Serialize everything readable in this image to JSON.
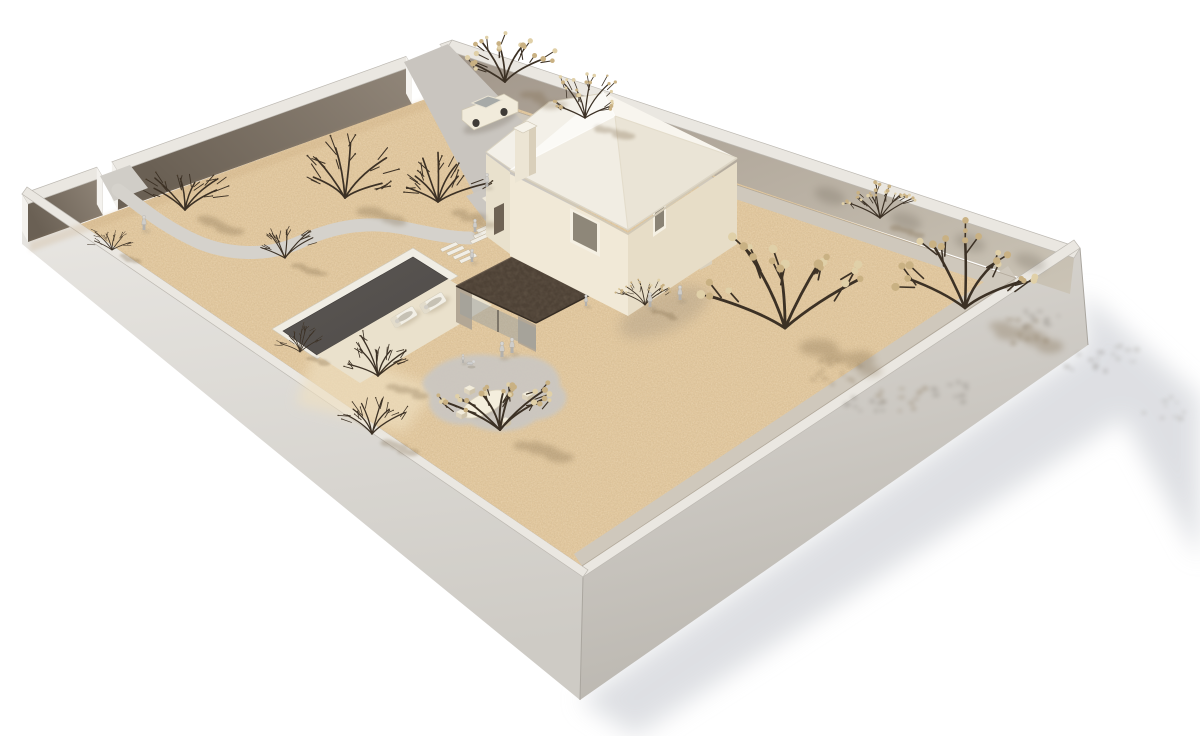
{
  "scene": {
    "width": 1200,
    "height": 736,
    "background": "#ffffff",
    "description": "Aerial 3D architectural rendering of a walled residential plot: two-storey house with pyramidal roof and chimney, dark flat-roofed pool pavilion, rectangular pool with sun loungers, winding footpath from a gate, driveway with parked car, gravel ground, flowering trees and small human figures"
  },
  "palette": {
    "bg": "#ffffff",
    "wallCap": "#eae7e1",
    "wallCapEdge": "#bdb9b2",
    "wallEnd": "#f4f2ee",
    "gradNW1": "#6a6054",
    "gradNW2": "#918679",
    "gradNE1": "#a1968a",
    "gradNE2": "#cbc4b6",
    "gradSWout1": "#e9e7e3",
    "gradSWout2": "#cecbc5",
    "gradSEout1": "#dedbd6",
    "gradSEout2": "#bab6af",
    "seam": "#aaa69f",
    "sand": "#e2c89f",
    "sandLight": "#efe0c1",
    "sandEdgeShade": "#c3a276",
    "stripGray": "#cfc8bc",
    "baseLine": "#a79d8e",
    "pathGray": "#d5d2cc",
    "driveGray": "#c9c5bf",
    "courtGray": "#cbc7c1",
    "gatePad": "#d0cdc7",
    "terrace": "#eee8d9",
    "poolWater1": "#5b5754",
    "poolWater2": "#4f4b48",
    "poolCoping": "#f0ede4",
    "poolDeck": "#eae1cc",
    "plank": "#f1eee6",
    "houseLight": "#f1e9d7",
    "houseMid": "#e7ddc7",
    "houseWing": "#e9e1cd",
    "roofNW": "#fbfaf6",
    "roofNE": "#f8f5ee",
    "roofSE": "#eae4d6",
    "roofSW": "#f1ede3",
    "wingRoof": "#f3f0e8",
    "fascia": "#d2c9b6",
    "ridgeLight": "#fdfcf9",
    "ridgeDark": "#e3dccb",
    "chimFront": "#ece5d4",
    "chimSide": "#d9cfba",
    "chimCap": "#f6f3ea",
    "doorDark": "#6e6254",
    "winFrame": "#f5f0e3",
    "winGlass": "#8e8779",
    "darkRoof": "#4e4236",
    "darkRoofEdge": "#352c23",
    "darkRoofHi": "#6a5c4d",
    "pier": "#b3a795",
    "pierLight": "#d9d0bd",
    "glass": "#9aa0a0",
    "mullion": "#4a443c",
    "interiorDark": "#463d33",
    "counterDark": "#2e2822",
    "treeBranch": "#3c3125",
    "bloom": "#c9b183",
    "bloomLight": "#e0d0a8",
    "budDark": "#4a3d2c",
    "shadowBrown": "#7c6647",
    "shadowGray": "#d6d8dd",
    "blobShadow": "#978b7c",
    "wallShadow": "#6b6255",
    "extSpeckle": "#9a958c",
    "figureLegs": "#b3b1ad",
    "figureBody": "#cfcdc9",
    "figureHead": "#d8d6d2",
    "figureEdge": "#a09e9a",
    "figureShadow": "#8a8070",
    "carBody": "#f1ebdb",
    "carGlass": "#a7aaa8",
    "carWheel": "#3f3b37",
    "carShadow": "#6f6658"
  },
  "walls": {
    "nw": {
      "from": [
        22,
        194
      ],
      "to": [
        452,
        40
      ],
      "capOffset": [
        6,
        10
      ],
      "faceHeight": 38,
      "segments": [
        [
          0,
          0.174
        ],
        [
          0.209,
          0.893
        ],
        [
          0.972,
          1.0
        ]
      ]
    },
    "neCap": [
      [
        452,
        40
      ],
      [
        1080,
        248
      ],
      [
        1074,
        258
      ],
      [
        446,
        50
      ]
    ],
    "neFace": [
      [
        446,
        50
      ],
      [
        1074,
        258
      ],
      [
        1070,
        294
      ],
      [
        446,
        88
      ]
    ],
    "seCap": [
      [
        1080,
        248
      ],
      [
        583,
        577
      ],
      [
        577,
        569
      ],
      [
        1074,
        240
      ]
    ],
    "swCap": [
      [
        583,
        577
      ],
      [
        22,
        194
      ],
      [
        27,
        187
      ],
      [
        588,
        570
      ]
    ],
    "seOuter": [
      [
        1080,
        248
      ],
      [
        583,
        577
      ],
      [
        580,
        700
      ],
      [
        1088,
        345
      ]
    ],
    "swOuter": [
      [
        583,
        577
      ],
      [
        22,
        194
      ],
      [
        22,
        244
      ],
      [
        580,
        700
      ]
    ],
    "seamE": [
      [
        1080,
        248
      ],
      [
        1088,
        345
      ]
    ],
    "seamS": [
      [
        583,
        577
      ],
      [
        580,
        700
      ]
    ]
  },
  "ground": {
    "sand": [
      [
        81,
        224
      ],
      [
        456,
        88
      ],
      [
        1016,
        278
      ],
      [
        582,
        566
      ]
    ],
    "stripNE": [
      [
        446,
        88
      ],
      [
        1016,
        278
      ],
      [
        1011,
        291
      ],
      [
        442,
        101
      ]
    ],
    "stripSE": [
      [
        1016,
        278
      ],
      [
        582,
        566
      ],
      [
        574,
        554
      ],
      [
        1008,
        266
      ]
    ],
    "baseLineNE": [
      [
        446,
        88
      ],
      [
        1016,
        278
      ]
    ],
    "baseLineSE": [
      [
        1016,
        278
      ],
      [
        582,
        566
      ]
    ],
    "nwEdgeShade": [
      [
        30,
        242
      ],
      [
        456,
        88
      ],
      [
        456,
        98
      ],
      [
        30,
        252
      ]
    ],
    "beach": [
      [
        318,
        342
      ],
      [
        436,
        388
      ],
      [
        404,
        432
      ],
      [
        296,
        404
      ]
    ]
  },
  "paths": {
    "gatePad": [
      [
        100,
        176
      ],
      [
        130,
        165
      ],
      [
        148,
        188
      ],
      [
        114,
        201
      ]
    ],
    "walk": "M118,190 C140,206 162,226 198,242 C226,254 266,258 300,242 C330,228 364,220 404,228 C432,234 452,238 470,238",
    "walkWidth": 13,
    "drive": [
      [
        404,
        62
      ],
      [
        448,
        44
      ],
      [
        560,
        160
      ],
      [
        480,
        205
      ]
    ],
    "court": [
      [
        466,
        196
      ],
      [
        556,
        162
      ],
      [
        592,
        200
      ],
      [
        502,
        242
      ]
    ],
    "terrace": [
      [
        482,
        198
      ],
      [
        514,
        184
      ],
      [
        536,
        204
      ],
      [
        504,
        219
      ]
    ],
    "poolSteps": {
      "x": 440,
      "y": 249,
      "count": 4,
      "dx": 6.3,
      "dy": 3.8,
      "len": 16
    },
    "entrySteps": {
      "x": 476,
      "y": 230,
      "count": 3,
      "dx": -3,
      "dy": 5.5,
      "len": 18
    }
  },
  "pool": {
    "coping": [
      [
        272,
        329
      ],
      [
        413,
        248
      ],
      [
        458,
        276
      ],
      [
        317,
        359
      ]
    ],
    "water": [
      [
        283,
        331
      ],
      [
        413,
        257
      ],
      [
        448,
        279
      ],
      [
        317,
        355
      ]
    ],
    "deck": [
      [
        448,
        279
      ],
      [
        492,
        305
      ],
      [
        360,
        383
      ],
      [
        317,
        355
      ]
    ],
    "loungers": [
      [
        404,
        317
      ],
      [
        433,
        303
      ]
    ]
  },
  "patio": {
    "blob": "M430,372 C446,356 478,350 506,358 C536,350 562,366 560,386 C576,398 560,418 536,420 C520,434 488,434 470,424 C444,428 424,412 430,396 C420,386 420,380 430,372 Z",
    "table": {
      "cx": 484,
      "cy": 404,
      "rx": 24,
      "ry": 10,
      "rot": -27
    },
    "chairs": [
      [
        456,
        412
      ],
      [
        500,
        420
      ],
      [
        522,
        394
      ],
      [
        464,
        388
      ]
    ]
  },
  "pavilion": {
    "interior": [
      [
        466,
        290
      ],
      [
        562,
        240
      ],
      [
        634,
        272
      ],
      [
        540,
        318
      ]
    ],
    "counter": [
      [
        562,
        298
      ],
      [
        608,
        274
      ],
      [
        608,
        284
      ],
      [
        562,
        308
      ]
    ],
    "glassSW": [
      [
        460,
        292
      ],
      [
        536,
        328
      ],
      [
        536,
        350
      ],
      [
        460,
        314
      ]
    ],
    "piers": [
      [
        [
          456,
          286
        ],
        [
          472,
          294
        ],
        [
          472,
          330
        ],
        [
          456,
          322
        ]
      ],
      [
        [
          518,
          316
        ],
        [
          536,
          325
        ],
        [
          536,
          352
        ],
        [
          518,
          343
        ]
      ],
      [
        [
          558,
          238
        ],
        [
          570,
          232
        ],
        [
          570,
          264
        ],
        [
          558,
          270
        ]
      ]
    ],
    "roof": [
      [
        456,
        286
      ],
      [
        566,
        229
      ],
      [
        646,
        266
      ],
      [
        536,
        323
      ]
    ],
    "canopy": [
      [
        624,
        268
      ],
      [
        708,
        230
      ],
      [
        716,
        238
      ],
      [
        632,
        276
      ]
    ],
    "canopyInterior": [
      [
        632,
        276
      ],
      [
        706,
        242
      ],
      [
        706,
        254
      ],
      [
        632,
        288
      ]
    ],
    "lowerGlass": [
      [
        630,
        278
      ],
      [
        708,
        244
      ],
      [
        708,
        264
      ],
      [
        630,
        298
      ]
    ],
    "pierE": [
      [
        700,
        238
      ],
      [
        712,
        232
      ],
      [
        712,
        264
      ],
      [
        700,
        270
      ]
    ],
    "pierS": [
      [
        628,
        280
      ],
      [
        640,
        274
      ],
      [
        640,
        302
      ],
      [
        628,
        308
      ]
    ],
    "shadowBlob": {
      "cx": 664,
      "cy": 312,
      "rx": 48,
      "ry": 20,
      "rot": -24
    }
  },
  "house": {
    "swFace": [
      [
        510,
        174
      ],
      [
        628,
        234
      ],
      [
        628,
        316
      ],
      [
        510,
        256
      ]
    ],
    "seFace": [
      [
        628,
        234
      ],
      [
        737,
        162
      ],
      [
        737,
        244
      ],
      [
        628,
        316
      ]
    ],
    "apex": [
      615,
      116
    ],
    "eaveW": [
      510,
      170
    ],
    "eaveN": [
      603,
      92
    ],
    "eaveE": [
      737,
      158
    ],
    "eaveS": [
      628,
      230
    ],
    "wingRoof": [
      [
        486,
        152
      ],
      [
        549,
        102
      ],
      [
        604,
        93
      ],
      [
        512,
        170
      ]
    ],
    "wingFace": [
      [
        486,
        154
      ],
      [
        510,
        172
      ],
      [
        510,
        254
      ],
      [
        486,
        236
      ]
    ],
    "door": [
      [
        494,
        208
      ],
      [
        504,
        203
      ],
      [
        504,
        230
      ],
      [
        494,
        235
      ]
    ],
    "chimneyFront": [
      [
        515,
        130
      ],
      [
        529,
        123
      ],
      [
        529,
        176
      ],
      [
        515,
        183
      ]
    ],
    "chimneySide": [
      [
        529,
        123
      ],
      [
        536,
        127
      ],
      [
        536,
        173
      ],
      [
        529,
        176
      ]
    ],
    "chimneyCap": [
      [
        513,
        128
      ],
      [
        527,
        121
      ],
      [
        537,
        126
      ],
      [
        523,
        133
      ]
    ],
    "winSwFrame": [
      [
        570,
        208
      ],
      [
        600,
        223
      ],
      [
        600,
        257
      ],
      [
        570,
        242
      ]
    ],
    "winSwGlass": [
      [
        573,
        212
      ],
      [
        597,
        224
      ],
      [
        597,
        252
      ],
      [
        573,
        240
      ]
    ],
    "winWingFrame": [
      [
        517,
        194
      ],
      [
        537,
        204
      ],
      [
        537,
        248
      ],
      [
        517,
        238
      ]
    ],
    "winWingGlass": [
      [
        520,
        198
      ],
      [
        534,
        205
      ],
      [
        534,
        244
      ],
      [
        520,
        237
      ]
    ],
    "winSeFrame": [
      [
        653,
        199
      ],
      [
        666,
        190
      ],
      [
        666,
        228
      ],
      [
        653,
        237
      ]
    ],
    "winSeGlass": [
      [
        655,
        202
      ],
      [
        664,
        196
      ],
      [
        664,
        226
      ],
      [
        655,
        232
      ]
    ]
  },
  "car": {
    "body": [
      [
        462,
        110
      ],
      [
        504,
        94
      ],
      [
        518,
        102
      ],
      [
        518,
        112
      ],
      [
        474,
        130
      ],
      [
        462,
        120
      ]
    ],
    "cabin": [
      [
        472,
        103
      ],
      [
        488,
        96
      ],
      [
        502,
        100
      ],
      [
        486,
        108
      ]
    ],
    "wheels": [
      [
        476,
        123
      ],
      [
        504,
        112
      ]
    ],
    "shadow": {
      "cx": 490,
      "cy": 122,
      "rx": 28,
      "ry": 8,
      "rot": -20
    }
  },
  "trees": [
    [
      185,
      210,
      1.0,
      0
    ],
    [
      285,
      258,
      0.75,
      0
    ],
    [
      345,
      198,
      1.15,
      0
    ],
    [
      438,
      202,
      1.1,
      0
    ],
    [
      505,
      82,
      1.15,
      1
    ],
    [
      585,
      118,
      0.85,
      1
    ],
    [
      112,
      250,
      0.55,
      0
    ],
    [
      378,
      376,
      0.9,
      0
    ],
    [
      300,
      352,
      0.55,
      0
    ],
    [
      372,
      434,
      0.85,
      0
    ],
    [
      500,
      430,
      1.3,
      1
    ],
    [
      645,
      305,
      0.6,
      1
    ],
    [
      880,
      218,
      0.8,
      1
    ],
    [
      785,
      328,
      1.9,
      1
    ],
    [
      965,
      308,
      1.7,
      1
    ]
  ],
  "people": [
    [
      144,
      230,
      0.9
    ],
    [
      487,
      187,
      0.85
    ],
    [
      475,
      232,
      0.8
    ],
    [
      472,
      262,
      0.8
    ],
    [
      502,
      357,
      0.95
    ],
    [
      512,
      353,
      0.95
    ],
    [
      650,
      307,
      0.9
    ],
    [
      680,
      300,
      0.9
    ],
    [
      586,
      306,
      0.7
    ],
    [
      463,
      363,
      0.55
    ]
  ],
  "dog": [
    470,
    366
  ],
  "wallShadows": {
    "neFaceBlobs": [
      [
        830,
        196
      ],
      [
        906,
        221
      ],
      [
        970,
        243
      ],
      [
        1030,
        262
      ]
    ],
    "sandClusters": [
      [
        838,
        372
      ],
      [
        902,
        398
      ],
      [
        1028,
        332
      ]
    ],
    "seOuterClusters": [
      [
        1040,
        318
      ],
      [
        1086,
        362
      ],
      [
        948,
        392
      ],
      [
        866,
        404
      ]
    ],
    "groundClusters": [
      [
        1118,
        356
      ],
      [
        1162,
        408
      ]
    ]
  },
  "extShadows": {
    "right": [
      [
        1082,
        292
      ],
      [
        1200,
        398
      ],
      [
        1200,
        560
      ],
      [
        1088,
        352
      ]
    ],
    "bottom": [
      [
        580,
        700
      ],
      [
        1088,
        345
      ],
      [
        1143,
        405
      ],
      [
        635,
        736
      ]
    ]
  }
}
